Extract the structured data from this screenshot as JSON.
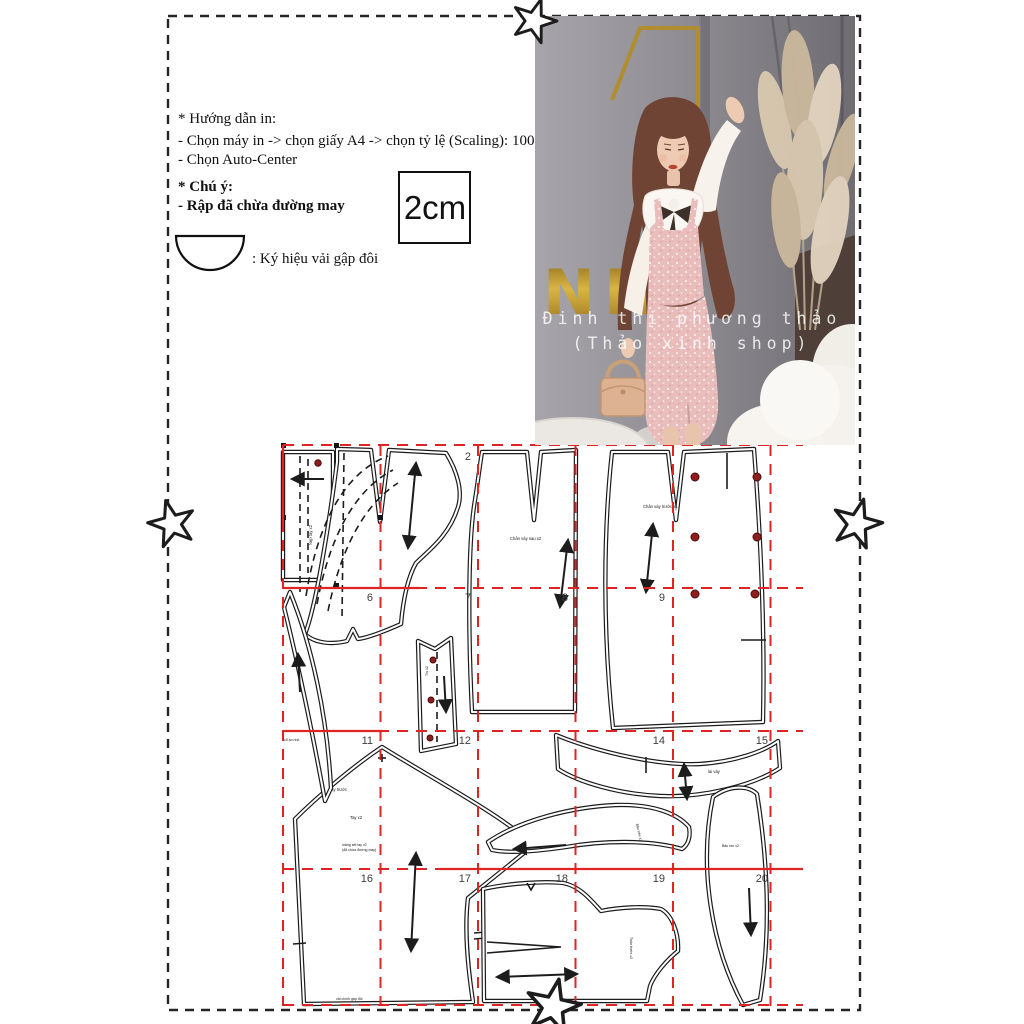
{
  "colors": {
    "grid_red": "#e02424",
    "button_red": "#8f1d1d",
    "gold": "#c09a33",
    "dress_pink": "#e9bdbc",
    "line_black": "#1c1c1c"
  },
  "instructions": {
    "heading": "* Hướng dẫn in:",
    "line1": "- Chọn máy in -> chọn giấy A4 -> chọn tỷ lệ (Scaling): 100%",
    "line2": "- Chọn Auto-Center",
    "note_heading": "* Chú ý:",
    "note_line": "- Rập đã chừa đường may"
  },
  "scale_box": {
    "label": "2cm"
  },
  "fold_symbol": {
    "caption": ": Ký hiệu vải gập đôi"
  },
  "photo": {
    "sign_text": "NH",
    "watermark_line1": "Đinh thị phương thảo",
    "watermark_line2": "(Thảo xinh shop)"
  },
  "pattern": {
    "page_numbers": {
      "p2": "2",
      "p6": "6",
      "p7": "7",
      "p8": "8",
      "p9": "9",
      "p11": "11",
      "p12": "12",
      "p14": "14",
      "p15": "15",
      "p16": "16",
      "p17": "17",
      "p18": "18",
      "p19": "19",
      "p20": "20"
    },
    "labels": {
      "cuff_strip": "Nẹp tay x2",
      "skirt_back": "Chân váy sau x2",
      "skirt_front": "Chân váy trước x1",
      "neck_facing": "cổ áo nhỏ",
      "placket": "Trụ x2",
      "hem_band": "lai váy",
      "sleeve_front": "tay trước",
      "sleeve": "Tay x2",
      "sleeve_note1": "măng sét tay x2",
      "sleeve_note2": "(đã chừa đường may)",
      "sleeve_fold": "vải chính gập đôi",
      "collar": "Bâu trên x2",
      "collar_band": "Bâu lớn x2",
      "bodice_front": "Thân trước x2"
    }
  }
}
